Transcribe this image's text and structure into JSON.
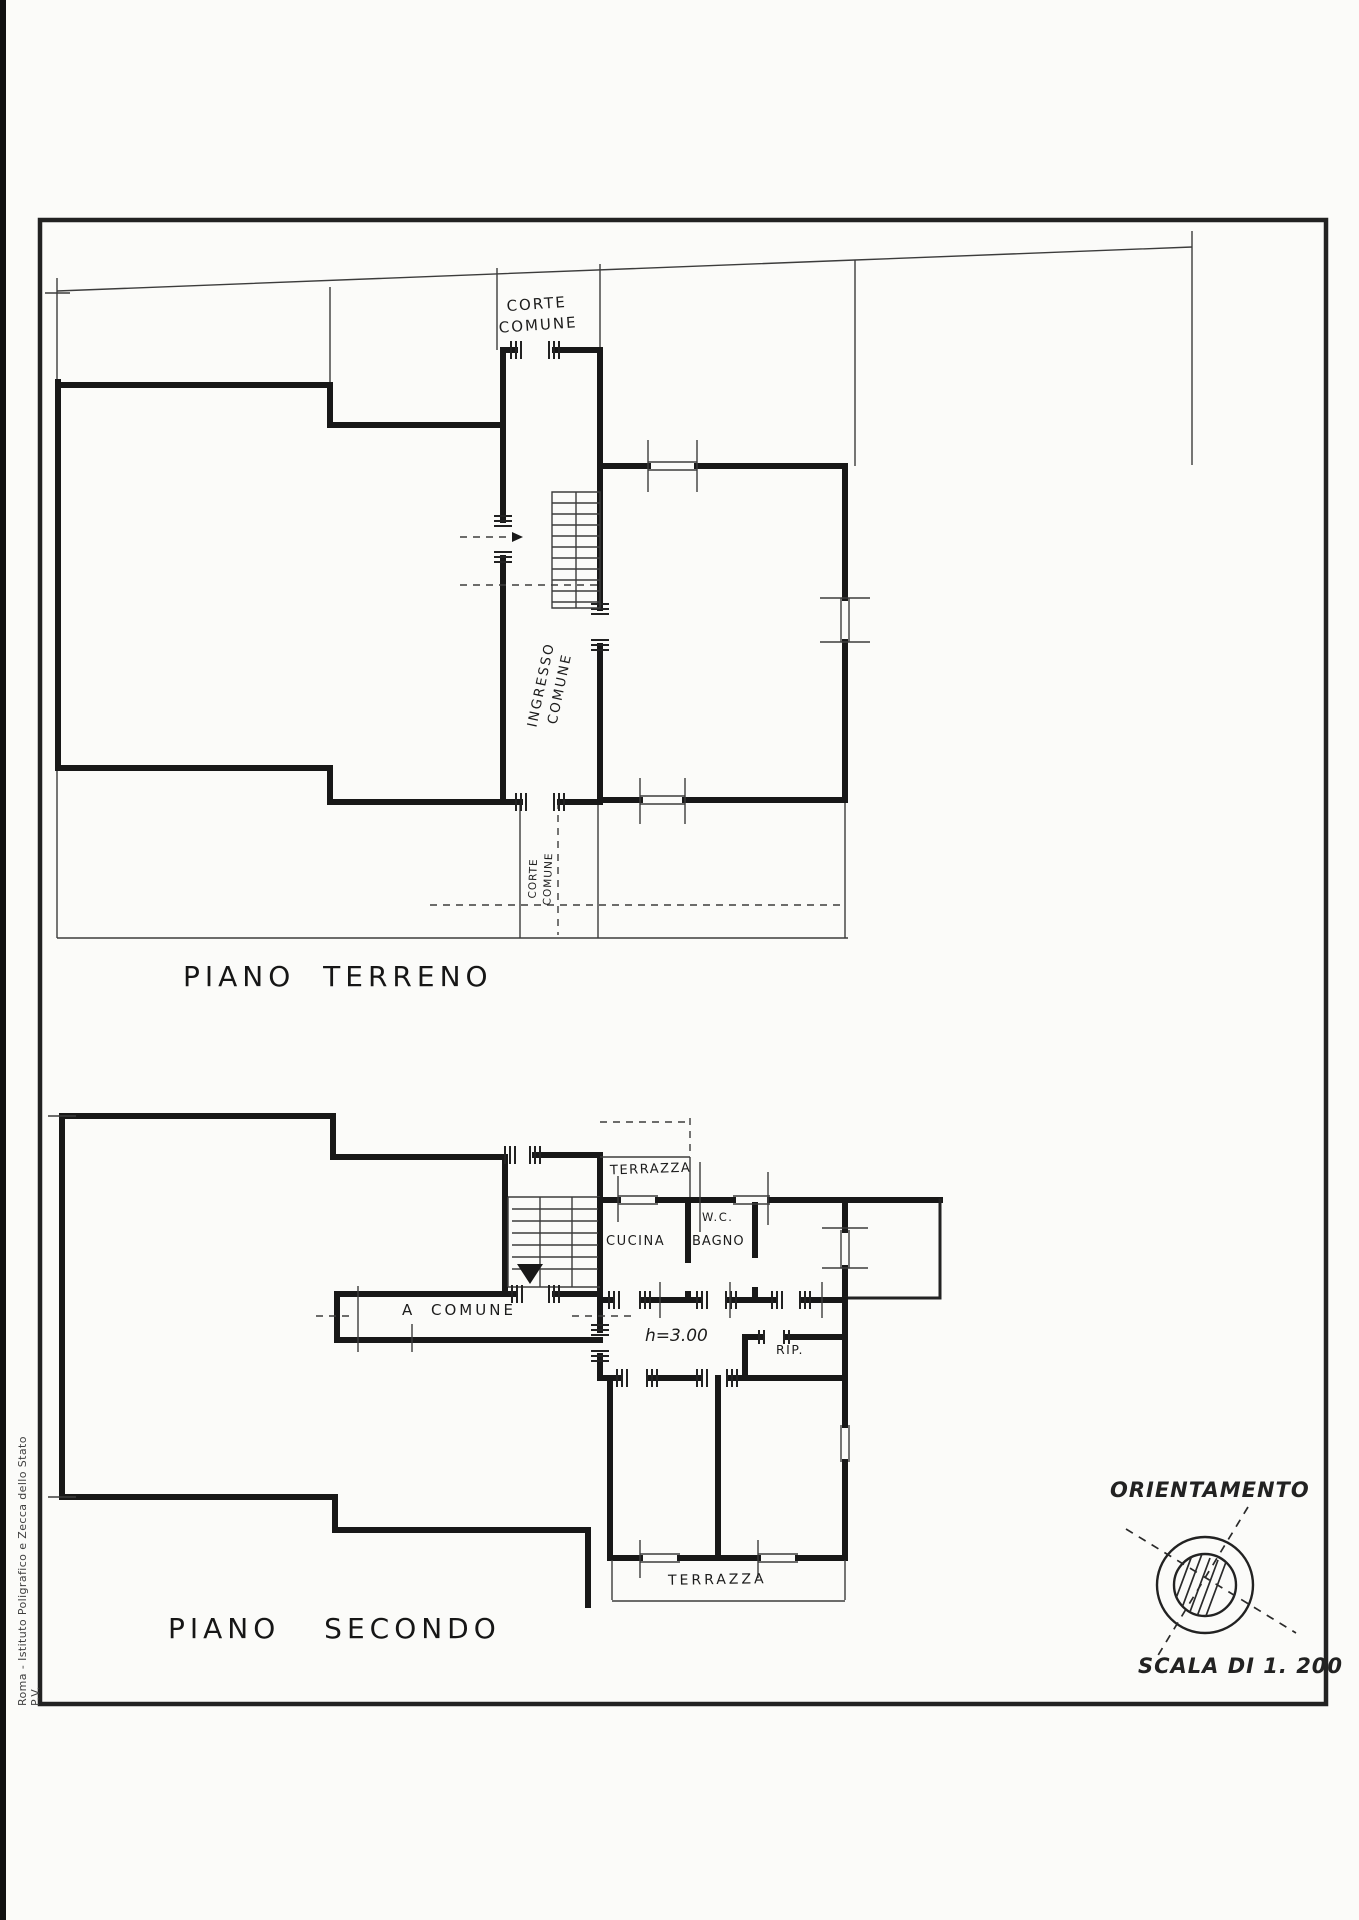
{
  "sheet": {
    "imprint": "Roma - Istituto Poligrafico e Zecca dello Stato P.V.",
    "orientation_label": "ORIENTAMENTO",
    "scale_label": "SCALA DI 1. 200"
  },
  "ground_floor": {
    "title": "PIANO TERRENO",
    "corte_comune_top": {
      "line1": "CORTE",
      "line2": "COMUNE"
    },
    "ingresso_comune": {
      "line1": "INGRESSO",
      "line2": "COMUNE"
    },
    "corte_comune_bottom": {
      "line1": "CORTE",
      "line2": "COMUNE"
    }
  },
  "second_floor": {
    "title": "PIANO SECONDO",
    "terrazza_top": "TERRAZZA",
    "wc": "W.C.",
    "cucina": "CUCINA",
    "bagno": "BAGNO",
    "corridor": "A COMUNE",
    "ceiling_height": "h=3.00",
    "rip": "RIP.",
    "terrazza_bottom": "TERRAZZA"
  }
}
